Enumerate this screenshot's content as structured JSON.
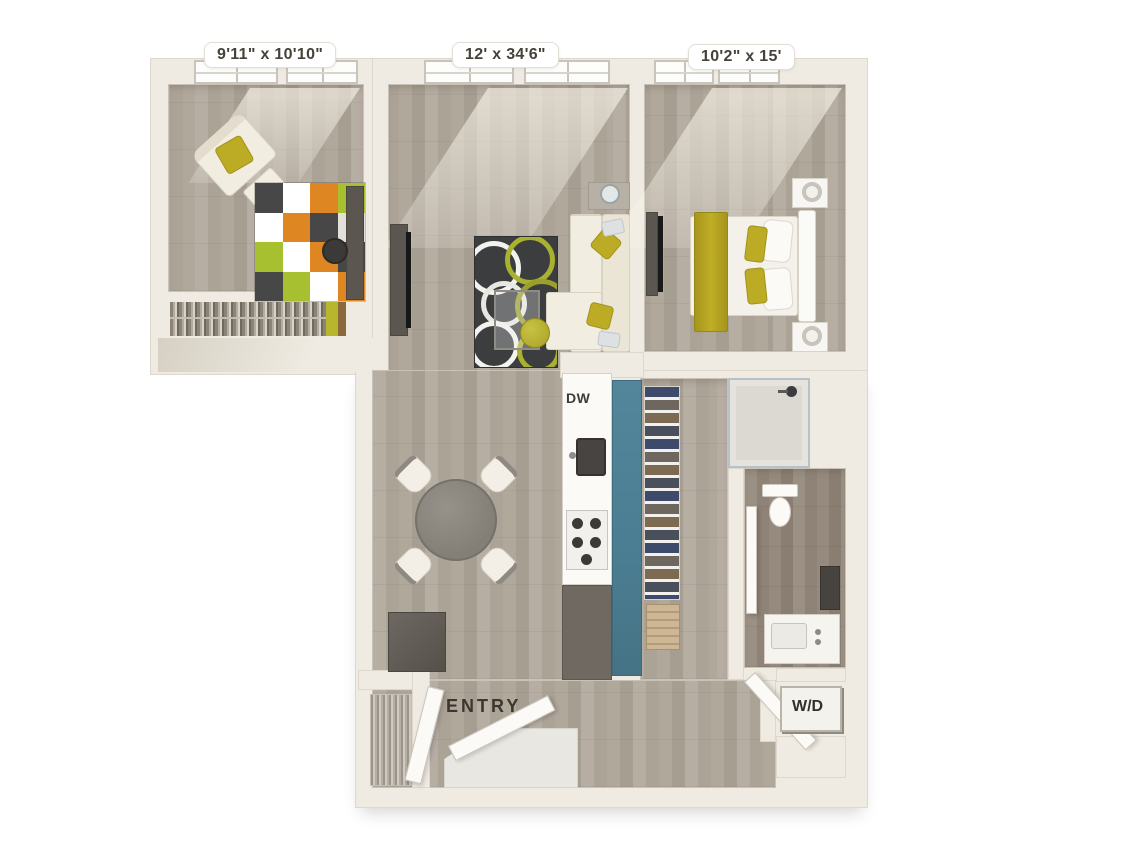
{
  "page": {
    "type": "3D apartment floor plan rendering",
    "background": "#ffffff"
  },
  "labels": {
    "den_dimensions": "9'11\" x 10'10\"",
    "living_dimensions": "12' x 34'6\"",
    "bedroom_dimensions": "10'2\" x 15'",
    "dishwasher": "DW",
    "entry": "ENTRY",
    "washer_dryer": "W/D"
  },
  "rooms": [
    {
      "name": "den",
      "dimensions": "9'11\" x 10'10\""
    },
    {
      "name": "living-dining-kitchen",
      "dimensions": "12' x 34'6\""
    },
    {
      "name": "bedroom",
      "dimensions": "10'2\" x 15'"
    },
    {
      "name": "bathroom",
      "dimensions": ""
    },
    {
      "name": "walk-in-closet",
      "dimensions": ""
    },
    {
      "name": "entry",
      "dimensions": ""
    },
    {
      "name": "laundry-closet",
      "dimensions": ""
    }
  ],
  "colors": {
    "wall": "#efebe2",
    "wood_floor": "#b2a99f",
    "bathroom_floor": "#998d81",
    "kitchen_island_accent": "#4e8095",
    "upholstery_accent": "#bcab24",
    "rug_dark": "#3b3d3e",
    "rug_orange": "#dd8622",
    "rug_green": "#a6c02f",
    "sofa_cream": "#f2ede1",
    "furniture_dark": "#5b5650"
  }
}
